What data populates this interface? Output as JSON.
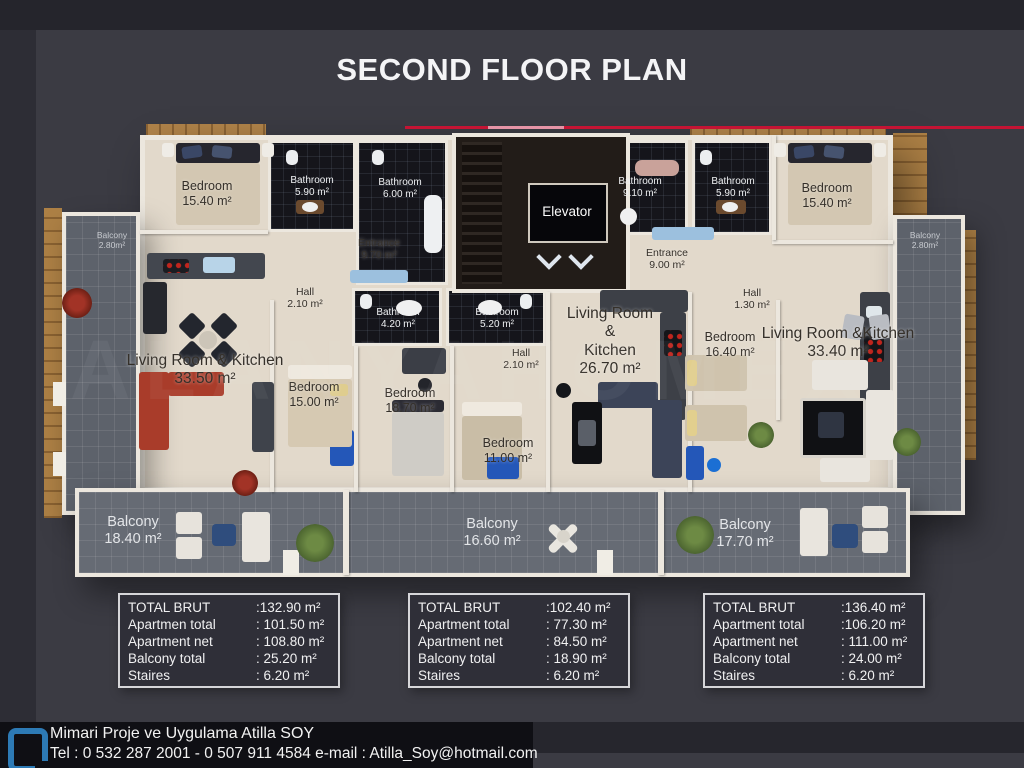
{
  "title": "SECOND FLOOR PLAN",
  "watermark": "ALANYAHOMEX",
  "plan": {
    "rooms": [
      {
        "lines": [
          "Bedroom"
        ],
        "area": "15.40 m²",
        "x": 207,
        "y": 179,
        "variant": "md-dark"
      },
      {
        "lines": [
          "Bathroom"
        ],
        "area": "5.90 m²",
        "x": 312,
        "y": 175,
        "variant": "sm-light"
      },
      {
        "lines": [
          "Bathroom"
        ],
        "area": "6.00 m²",
        "x": 400,
        "y": 177,
        "variant": "sm-light"
      },
      {
        "lines": [
          "Balcony"
        ],
        "area": "2.80m²",
        "x": 112,
        "y": 230,
        "variant": "xs-light"
      },
      {
        "lines": [
          "Entrance"
        ],
        "area": "9.70 m²",
        "x": 379,
        "y": 237,
        "variant": "sm-dark"
      },
      {
        "lines": [
          "Hall"
        ],
        "area": "2.10 m²",
        "x": 305,
        "y": 286,
        "variant": "sm-dark"
      },
      {
        "lines": [
          "Bathroom"
        ],
        "area": "4.20 m²",
        "x": 398,
        "y": 307,
        "variant": "sm-light"
      },
      {
        "lines": [
          "Living Room & Kitchen"
        ],
        "area": "33.50 m²",
        "x": 205,
        "y": 352,
        "variant": "lg-dark"
      },
      {
        "lines": [
          "Bedroom"
        ],
        "area": "15.00 m²",
        "x": 314,
        "y": 380,
        "variant": "md-dark"
      },
      {
        "lines": [
          "Bedroom"
        ],
        "area": "18.70 m²",
        "x": 410,
        "y": 386,
        "variant": "md-dark"
      },
      {
        "lines": [
          "Bathroom"
        ],
        "area": "5.20 m²",
        "x": 497,
        "y": 307,
        "variant": "sm-light"
      },
      {
        "lines": [
          "Hall"
        ],
        "area": "2.10 m²",
        "x": 521,
        "y": 347,
        "variant": "sm-dark"
      },
      {
        "lines": [
          "Bedroom"
        ],
        "area": "11.00 m²",
        "x": 508,
        "y": 436,
        "variant": "md-dark"
      },
      {
        "lines": [
          "Living Room",
          "&",
          "Kitchen"
        ],
        "area": "26.70 m²",
        "x": 610,
        "y": 305,
        "variant": "lg-dark"
      },
      {
        "lines": [
          "Bathroom"
        ],
        "area": "9.10 m²",
        "x": 640,
        "y": 176,
        "variant": "sm-light"
      },
      {
        "lines": [
          "Bathroom"
        ],
        "area": "5.90 m²",
        "x": 733,
        "y": 176,
        "variant": "sm-light"
      },
      {
        "lines": [
          "Entrance"
        ],
        "area": "9.00 m²",
        "x": 667,
        "y": 247,
        "variant": "sm-dark"
      },
      {
        "lines": [
          "Hall"
        ],
        "area": "1.30 m²",
        "x": 752,
        "y": 287,
        "variant": "sm-dark"
      },
      {
        "lines": [
          "Bedroom"
        ],
        "area": "16.40 m²",
        "x": 730,
        "y": 330,
        "variant": "md-dark"
      },
      {
        "lines": [
          "Living Room &Kitchen"
        ],
        "area": "33.40 m²",
        "x": 838,
        "y": 325,
        "variant": "lg-dark"
      },
      {
        "lines": [
          "Bedroom"
        ],
        "area": "15.40 m²",
        "x": 827,
        "y": 181,
        "variant": "md-dark"
      },
      {
        "lines": [
          "Balcony"
        ],
        "area": "2.80m²",
        "x": 925,
        "y": 230,
        "variant": "xs-light"
      },
      {
        "lines": [
          "Elevator"
        ],
        "area": "",
        "x": 567,
        "y": 204,
        "variant": "elev-light"
      },
      {
        "lines": [
          "Balcony"
        ],
        "area": "18.40 m²",
        "x": 133,
        "y": 514,
        "variant": "bal-light"
      },
      {
        "lines": [
          "Balcony"
        ],
        "area": "16.60 m²",
        "x": 492,
        "y": 516,
        "variant": "bal-light"
      },
      {
        "lines": [
          "Balcony"
        ],
        "area": "17.70 m²",
        "x": 745,
        "y": 517,
        "variant": "bal-light"
      }
    ]
  },
  "tables": [
    {
      "name": "apartment-1-specs",
      "rows": [
        [
          "TOTAL BRUT",
          ":132.90 m²"
        ],
        [
          "Apartmen total",
          ": 101.50 m²"
        ],
        [
          "Apartment net",
          ": 108.80 m²"
        ],
        [
          "Balcony total",
          ": 25.20 m²"
        ],
        [
          "Staires",
          ": 6.20 m²"
        ]
      ]
    },
    {
      "name": "apartment-2-specs",
      "rows": [
        [
          "TOTAL BRUT",
          ":102.40 m²"
        ],
        [
          "Apartment total",
          ": 77.30 m²"
        ],
        [
          "Apartment net",
          ": 84.50 m²"
        ],
        [
          "Balcony total",
          ": 18.90 m²"
        ],
        [
          "Staires",
          ": 6.20 m²"
        ]
      ]
    },
    {
      "name": "apartment-3-specs",
      "rows": [
        [
          "TOTAL BRUT",
          ":136.40 m²"
        ],
        [
          "Apartment total",
          ":106.20 m²"
        ],
        [
          "Apartment net",
          ": 111.00 m²"
        ],
        [
          "Balcony total",
          ": 24.00 m²"
        ],
        [
          "Staires",
          ": 6.20 m²"
        ]
      ]
    }
  ],
  "footer": {
    "line1": "Mimari Proje ve Uygulama Atilla SOY",
    "line2": "Tel : 0 532 287 2001 - 0 507 911 4584 e-mail : Atilla_Soy@hotmail.com"
  },
  "colors": {
    "accent_red": "#c41434",
    "logo_blue": "#2d7ab5",
    "background": "#3b3b43"
  }
}
